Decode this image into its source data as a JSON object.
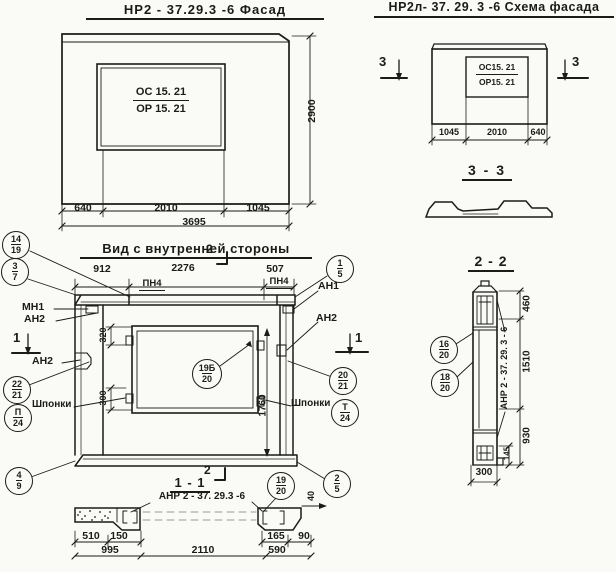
{
  "facade": {
    "title": "НР2 - 37.29.3  -6   Фасад",
    "mark_top": "ОС 15. 21",
    "mark_bottom": "ОР 15. 21",
    "dims": {
      "left": "640",
      "mid": "2010",
      "right": "1045",
      "total": "3695",
      "height": "2900"
    }
  },
  "schema": {
    "title": "НР2л- 37. 29. 3   -6   Схема фасада",
    "mark_top": "ОС15. 21",
    "mark_bottom": "ОР15. 21",
    "dims": {
      "left": "1045",
      "mid": "2010",
      "right": "640"
    },
    "marker": "3"
  },
  "section33": {
    "title": "3 - 3"
  },
  "section22": {
    "title": "2 - 2",
    "vertical_label": "АНР 2 - 37. 29. 3  - 6",
    "dims": {
      "top": "460",
      "mid": "1510",
      "bottom": "930",
      "small": "145",
      "width": "300"
    }
  },
  "inner": {
    "title": "Вид с внутренней  стороны",
    "dims": {
      "left": "912",
      "mid": "2276",
      "right": "507",
      "v320": "320",
      "v300": "300",
      "v1760": "1760"
    },
    "pn4": "ПН4",
    "mn1": "МН1",
    "an2": "АН2",
    "an1": "АН1",
    "shponki": "Шпонки",
    "marker1": "1",
    "marker2": "2"
  },
  "section11": {
    "title": "1 - 1",
    "label": "АНР 2 - 37. 29.3  -6",
    "dims": {
      "d510": "510",
      "d150": "150",
      "d995": "995",
      "d2110": "2110",
      "d165": "165",
      "d590": "590",
      "d90": "90",
      "d40": "40"
    }
  },
  "callouts": {
    "c14_19": {
      "top": "14",
      "bottom": "19"
    },
    "c3_7": {
      "top": "3",
      "bottom": "7"
    },
    "c1_5": {
      "top": "1",
      "bottom": "5"
    },
    "c20_21": {
      "top": "20",
      "bottom": "21"
    },
    "cT_24": {
      "top": "Т",
      "bottom": "24"
    },
    "cP_24": {
      "top": "П",
      "bottom": "24"
    },
    "c22_21": {
      "top": "22",
      "bottom": "21"
    },
    "c4_9": {
      "top": "4",
      "bottom": "9"
    },
    "c2_5": {
      "top": "2",
      "bottom": "5"
    },
    "c19_20": {
      "top": "19",
      "bottom": "20"
    },
    "c19b_20": {
      "top": "19Б",
      "bottom": "20"
    },
    "c16_20": {
      "top": "16",
      "bottom": "20"
    },
    "c18_20": {
      "top": "18",
      "bottom": "20"
    }
  }
}
